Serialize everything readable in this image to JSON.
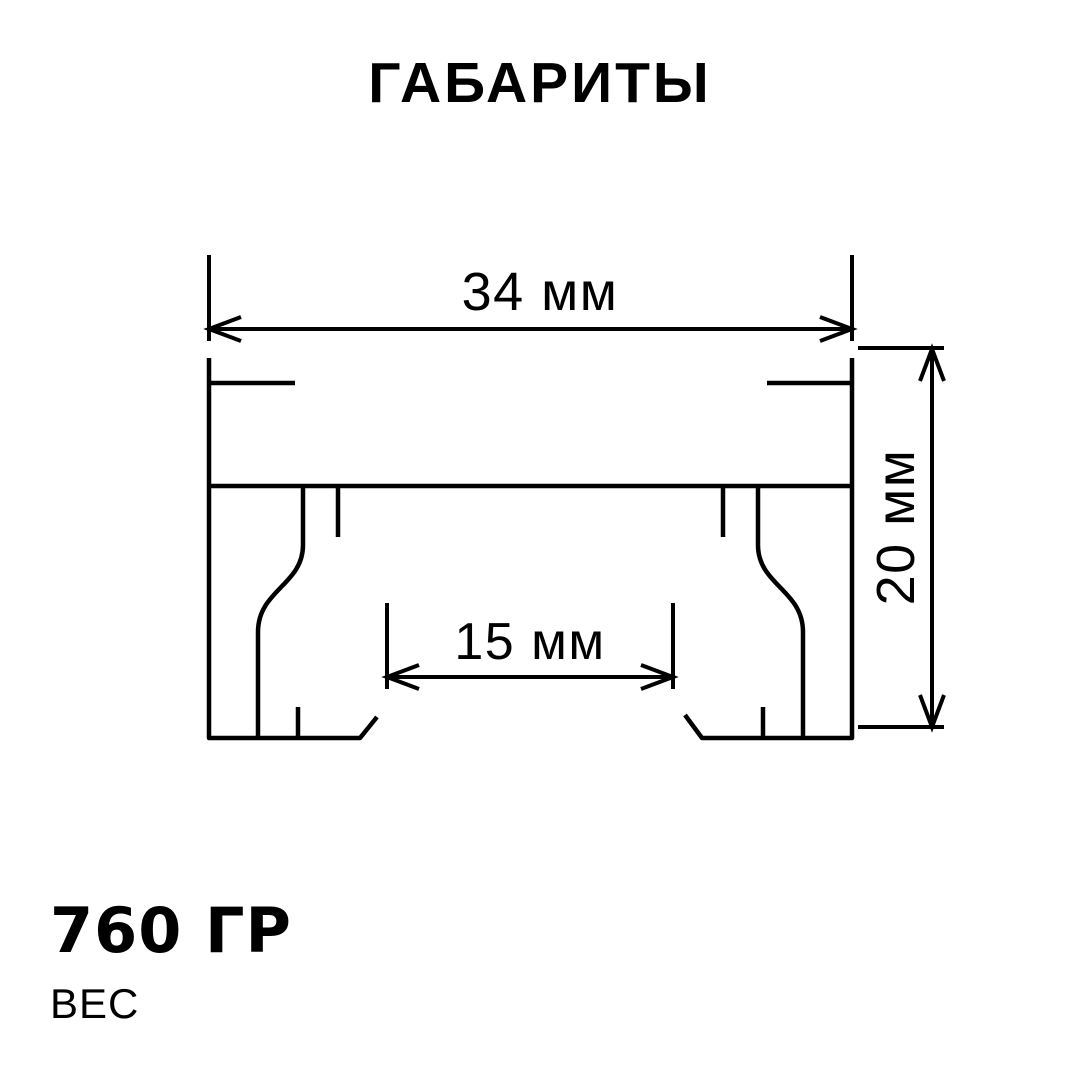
{
  "title": "ГАБАРИТЫ",
  "colors": {
    "ink": "#000000",
    "background": "#ffffff"
  },
  "diagram": {
    "description": "profile-cross-section",
    "dimensions": {
      "width": "34 мм",
      "height": "20 мм",
      "inner_width": "15 мм"
    }
  },
  "weight": {
    "value": "760 ГР",
    "label": "ВЕС"
  }
}
